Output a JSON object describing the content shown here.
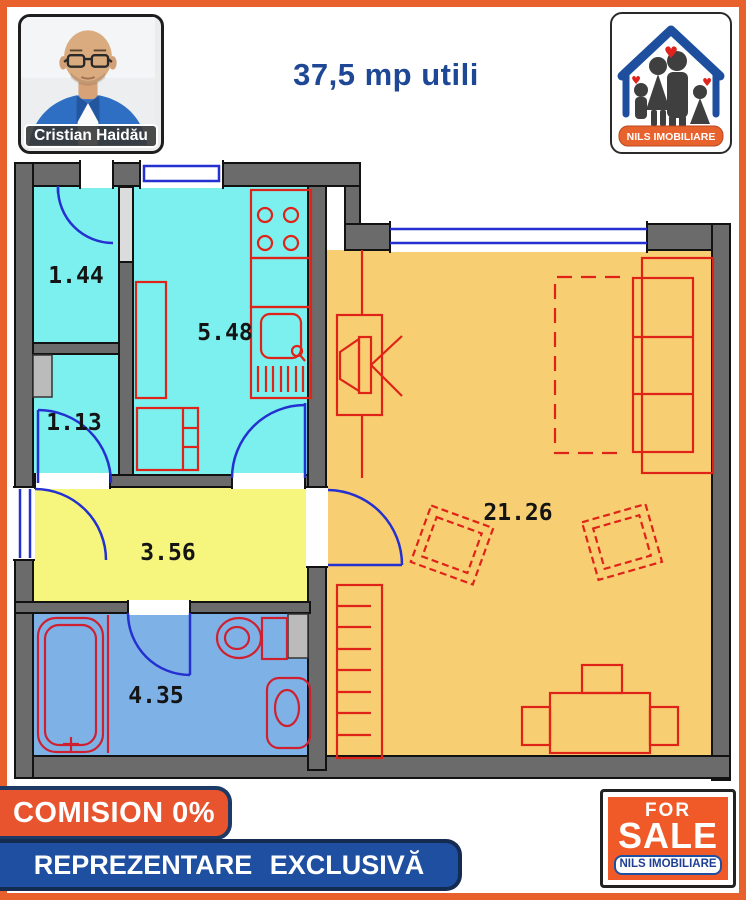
{
  "header": {
    "agent": {
      "name": "Cristian Haidău"
    },
    "area_label": "37,5 mp utili",
    "logo": {
      "brand": "NILS IMOBILIARE"
    }
  },
  "plan": {
    "rooms": [
      {
        "id": "storage-1",
        "area": "1.44"
      },
      {
        "id": "kitchen",
        "area": "5.48"
      },
      {
        "id": "storage-2",
        "area": "1.13"
      },
      {
        "id": "hallway",
        "area": "3.56"
      },
      {
        "id": "bathroom",
        "area": "4.35"
      },
      {
        "id": "living-room",
        "area": "21.26"
      }
    ],
    "colors": {
      "wall_gray": "#6b6b6b",
      "room_cyan": "#7cefef",
      "room_yellow": "#f6f67e",
      "room_blue": "#7eb2e6",
      "room_orange": "#f8ce72",
      "furniture_red": "#e02318",
      "fixture_crimson": "#cf2030",
      "door_blue": "#2430cf"
    }
  },
  "footer": {
    "commission_banner": "COMISION 0%",
    "representation_banner": "REPREZENTARE EXCLUSIVĂ",
    "sale_sign": {
      "top": "FOR",
      "middle": "SALE",
      "bottom": "NILS IMOBILIARE"
    }
  },
  "theme": {
    "frame_orange": "#e8612c",
    "banner_orange": "#e8542e",
    "banner_blue": "#1f4fa0",
    "headline_blue": "#1e4796"
  }
}
